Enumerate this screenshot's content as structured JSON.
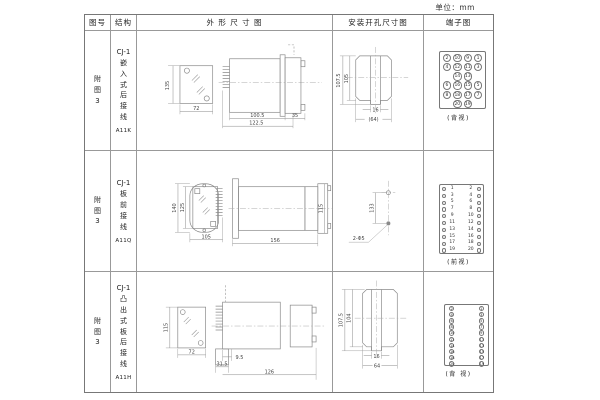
{
  "unit_note": "单位：mm",
  "table": {
    "headers": {
      "fig_no": "图号",
      "structure": "结构",
      "outline": "外 形 尺 寸 图",
      "mounting": "安装开孔尺寸图",
      "terminal": "端子图"
    },
    "rows": [
      {
        "fig_no": "附\n图\n3",
        "structure": "CJ-1\n嵌\n入\n式\n后\n接\n线",
        "model": "A11K"
      },
      {
        "fig_no": "附\n图\n3",
        "structure": "CJ-1\n板\n前\n接\n线",
        "model": "A11Q"
      },
      {
        "fig_no": "附\n图\n3",
        "structure": "CJ-1\n凸\n出\n式\n板\n后\n接\n线",
        "model": "A11H"
      }
    ]
  },
  "drawings": {
    "r1": {
      "front_h": "135",
      "front_w": "72",
      "side_d1": "100.5",
      "side_d2": "122.5",
      "side_d3": "35",
      "m_outer": "107.5",
      "m_inner": "105",
      "m_notch": "16",
      "m_width": "(64)"
    },
    "r2": {
      "front_h": "140",
      "front_h2": "125",
      "front_w": "105",
      "side_len": "156",
      "side_h": "115",
      "m_dist": "133",
      "m_holes": "2-Φ5"
    },
    "r3": {
      "front_h": "115",
      "front_w": "72",
      "side_d1": "9.5",
      "side_d2": "31.5",
      "side_d3": "126",
      "m_outer": "107.5",
      "m_inner": "104",
      "m_notch": "16",
      "m_width": "64"
    }
  },
  "terminals": {
    "r1": {
      "label": "(背视)",
      "rows": [
        [
          "2",
          "10",
          "9",
          "1"
        ],
        [
          "4",
          "12",
          "11",
          "3"
        ],
        [
          "",
          "14",
          "13",
          ""
        ],
        [
          "6",
          "16",
          "15",
          "5"
        ],
        [
          "8",
          "18",
          "17",
          "7"
        ],
        [
          "",
          "20",
          "19",
          ""
        ]
      ]
    },
    "r2": {
      "label": "(前视)",
      "left": [
        "1",
        "3",
        "5",
        "7",
        "9",
        "11",
        "13",
        "15",
        "17",
        "19"
      ],
      "right": [
        "2",
        "4",
        "6",
        "8",
        "10",
        "12",
        "14",
        "16",
        "18",
        "20"
      ]
    },
    "r3": {
      "label": "(背 视)",
      "left": [
        "2",
        "4",
        "6",
        "8",
        "10",
        "12",
        "14",
        "16",
        "18",
        "20"
      ],
      "right": [
        "1",
        "3",
        "5",
        "7",
        "9",
        "11",
        "13",
        "15",
        "17",
        "19"
      ]
    }
  }
}
